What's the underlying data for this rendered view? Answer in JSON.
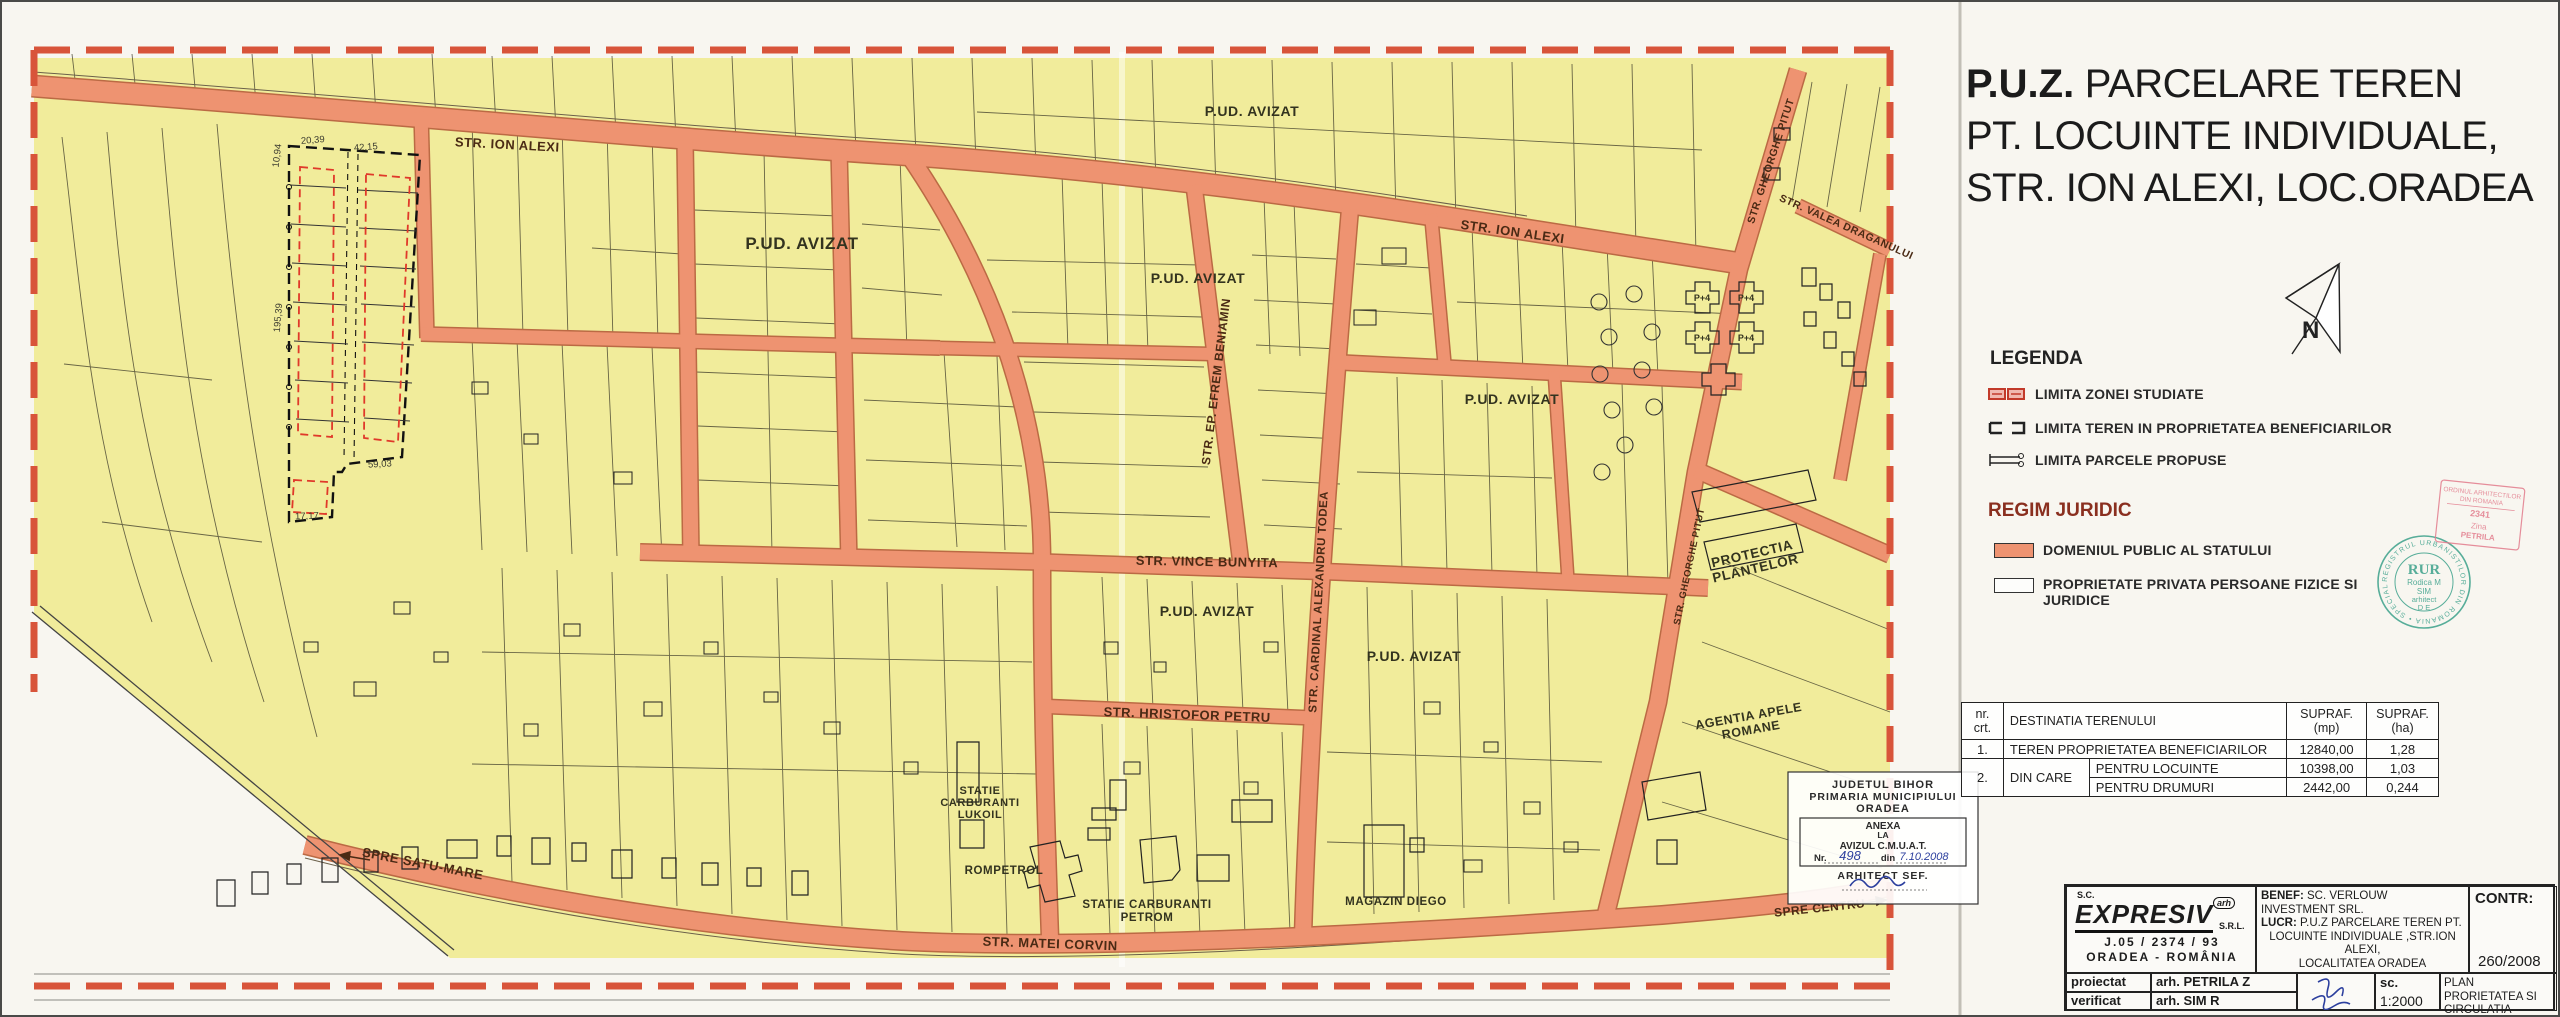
{
  "colors": {
    "map_yellow": "#f1ec9b",
    "road_salmon": "#ee9371",
    "boundary_red": "#d8543a",
    "stamp_green": "#2f9b84",
    "stamp_pink": "#e27b8c",
    "signature_blue": "#2c3f9e"
  },
  "title": {
    "puz": "P.U.Z.",
    "line1_rest": " PARCELARE TEREN",
    "line2": "PT. LOCUINTE INDIVIDUALE,",
    "line3": "STR. ION ALEXI, LOC.ORADEA"
  },
  "north": {
    "label": "N"
  },
  "legend": {
    "heading": "LEGENDA",
    "zona": "LIMITA ZONEI STUDIATE",
    "teren": "LIMITA TEREN IN PROPRIETATEA BENEFICIARILOR",
    "parcele": "LIMITA PARCELE PROPUSE"
  },
  "regim": {
    "heading": "REGIM JURIDIC",
    "public": "DOMENIUL PUBLIC AL STATULUI",
    "privat1": "PROPRIETATE PRIVATA PERSOANE FIZICE SI",
    "privat2": "JURIDICE"
  },
  "table": {
    "h_nr1": "nr.",
    "h_nr2": "crt.",
    "h_dest": "DESTINATIA TERENULUI",
    "h_mp1": "SUPRAF.",
    "h_mp2": "(mp)",
    "h_ha1": "SUPRAF.",
    "h_ha2": "(ha)",
    "r1_nr": "1.",
    "r1_dest": "TEREN PROPRIETATEA BENEFICIARILOR",
    "r1_mp": "12840,00",
    "r1_ha": "1,28",
    "r2_nr": "2.",
    "r2_dest": "DIN CARE",
    "r2a_sub": "PENTRU LOCUINTE",
    "r2a_mp": "10398,00",
    "r2a_ha": "1,03",
    "r2b_sub": "PENTRU DRUMURI",
    "r2b_mp": "2442,00",
    "r2b_ha": "0,244"
  },
  "titleblock": {
    "firm_sc": "S.C.",
    "firm_name": "EXPRESIV",
    "firm_arh": "arh",
    "firm_srl": "S.R.L.",
    "firm_reg": "J.05 / 2374 / 93",
    "firm_city": "ORADEA - ROMÂNIA",
    "benef_label": "BENEF:",
    "benef": "SC. VERLOUW INVESTMENT SRL.",
    "lucr_label": "LUCR:",
    "lucr1": "P.U.Z PARCELARE TEREN PT.",
    "lucr2": "LOCUINTE INDIVIDUALE ,STR.ION ALEXI,",
    "lucr3": "LOCALITATEA ORADEA",
    "contr_label": "CONTR:",
    "proj_no": "260/2008",
    "proiectat_label": "proiectat",
    "proiectat": "arh. PETRILA Z",
    "verificat_label": "verificat",
    "verificat": "arh. SIM R",
    "sc_label": "sc.",
    "scale": "1:2000",
    "plan1": "PLAN PRORIETATEA SI",
    "plan2": "CIRCULATIA TERENURILOR 4/U"
  },
  "stamps": {
    "rur_ring": "REGISTRUL URBANISTILOR DIN ROMANIA • SPECIALIST •",
    "rur": "RUR",
    "rur_name": "Rodica M",
    "rur_name2": "SIM",
    "rur_role": "arhitect",
    "rur_cat": "D E",
    "oar1": "ORDINUL ARHITECTILOR",
    "oar2": "DIN ROMANIA",
    "oar_no": "2341",
    "oar_fn": "Zina",
    "oar_ln": "PETRILA",
    "city1": "JUDETUL BIHOR",
    "city2": "PRIMARIA MUNICIPIULUI",
    "city3": "ORADEA",
    "city4": "ANEXA",
    "city5": "LA",
    "city6": "AVIZUL C.M.U.A.T.",
    "city_nr_label": "Nr.",
    "city_nr": "498",
    "city_din": "din",
    "city_date": "7.10.2008",
    "city7": "ARHITECT SEF."
  },
  "map": {
    "streets": {
      "ion_alexi_a": "STR. ION ALEXI",
      "ion_alexi_b": "STR. ION ALEXI",
      "vince": "STR. VINCE BUNYITA",
      "hristofor": "STR. HRISTOFOR PETRU",
      "efrem": "STR. EP. EFREM BENIAMIN",
      "todea": "STR. CARDINAL ALEXANDRU TODEA",
      "matei": "STR. MATEI CORVIN",
      "satu_mare": "SPRE SATU-MARE",
      "centru": "SPRE CENTRU",
      "pitut_a": "STR. GHEORGHE PITUT",
      "pitut_b": "STR. GHEORGHE PITUT",
      "valea": "STR. VALEA DRAGANULUI"
    },
    "areas": {
      "pud1": "P.UD. AVIZAT",
      "pud2": "P.UD. AVIZAT",
      "pud3": "P.UD. AVIZAT",
      "pud4": "P.UD. AVIZAT",
      "pud5": "P.UD. AVIZAT",
      "pud6": "P.UD. AVIZAT",
      "lukoil1": "STATIE",
      "lukoil2": "CARBURANTI",
      "lukoil3": "LUKOIL",
      "rompetrol": "ROMPETROL",
      "petrom1": "STATIE CARBURANTI",
      "petrom2": "PETROM",
      "diego": "MAGAZIN DIEGO",
      "protectia1": "PROTECTIA",
      "protectia2": "PLANTELOR",
      "agentia1": "AGENTIA APELE",
      "agentia2": "ROMANE",
      "p4": "P+4"
    },
    "dims": {
      "d1": "20,39",
      "d2": "42,15",
      "d3": "10,94",
      "d4": "195,39",
      "d5": "59,03",
      "d6": "17,17"
    }
  }
}
